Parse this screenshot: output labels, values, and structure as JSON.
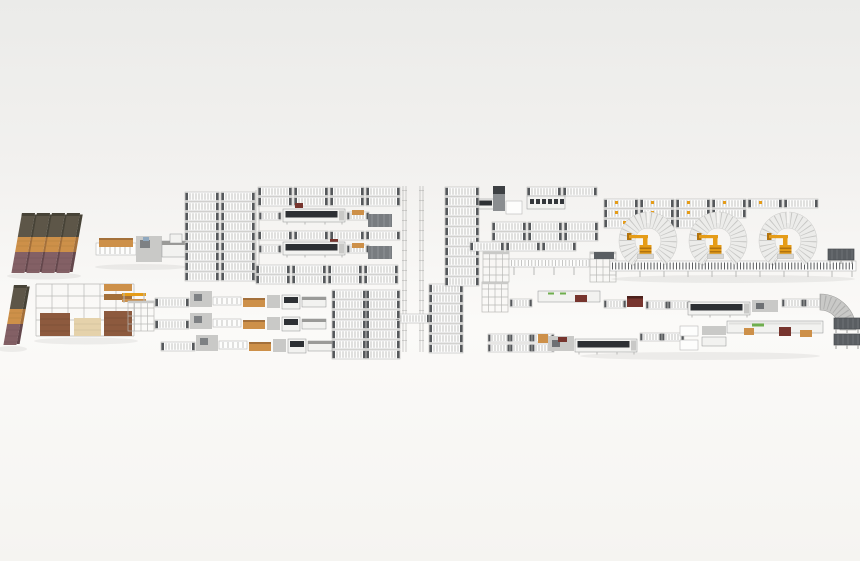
{
  "scene": {
    "visible_text": [],
    "components": [
      {
        "name": "board-stack-group-top-left",
        "count": 4
      },
      {
        "name": "board-stack-bottom-left",
        "count": 1
      },
      {
        "name": "storage-rack-with-material",
        "count": 1
      },
      {
        "name": "stack-feed-station",
        "count": 1
      },
      {
        "name": "roller-conveyor-buffer-fields",
        "count": 5
      },
      {
        "name": "long-machine-dark-hood",
        "count": 4
      },
      {
        "name": "gantry-processing-station",
        "count": 1
      },
      {
        "name": "parallel-processing-lines",
        "count": 3
      },
      {
        "name": "shuttle-rail-track",
        "count": 2
      },
      {
        "name": "robot-carousel-cell",
        "count": 3
      },
      {
        "name": "orange-robot",
        "count": 3
      },
      {
        "name": "slat-conveyor-robot-line",
        "count": 1
      },
      {
        "name": "upper-right-processing-line",
        "count": 1
      },
      {
        "name": "lower-right-processing-line",
        "count": 1
      },
      {
        "name": "curve-conveyor-90deg",
        "count": 1
      },
      {
        "name": "mesh-platform",
        "count": 5
      }
    ]
  },
  "colors": {
    "bg_top": "#ebebe9",
    "bg_mid": "#f2f1ef",
    "bg_floor": "#fbfaf8",
    "bg_bottom": "#f5f4f1",
    "conveyor_white": "#fdfdfc",
    "frame_gray": "#b9b9b7",
    "rung_gray": "#9c9c9a",
    "cap_dark": "#55585b",
    "machine_light": "#f2f2f0",
    "machine_mid": "#c9c9c7",
    "machine_dark": "#8f9193",
    "panel_dark": "#2d3034",
    "maroon": "#77352e",
    "robot_orange": "#e59c18",
    "robot_orange_dark": "#b07310",
    "wood_tan": "#cd9049",
    "wood_tan_dark": "#a4703a",
    "wood_cream": "#e5d2ab",
    "wood_brown": "#8d5a3e",
    "stack_olive": "#5d5648",
    "stack_olive_dark": "#474337",
    "stack_plum": "#836065",
    "stack_plum_dark": "#64474c",
    "arc_white": "#ececea",
    "arc_line": "#c2c2c0",
    "mesh_dark": "#5a5e62",
    "green_label": "#6fae4e"
  }
}
